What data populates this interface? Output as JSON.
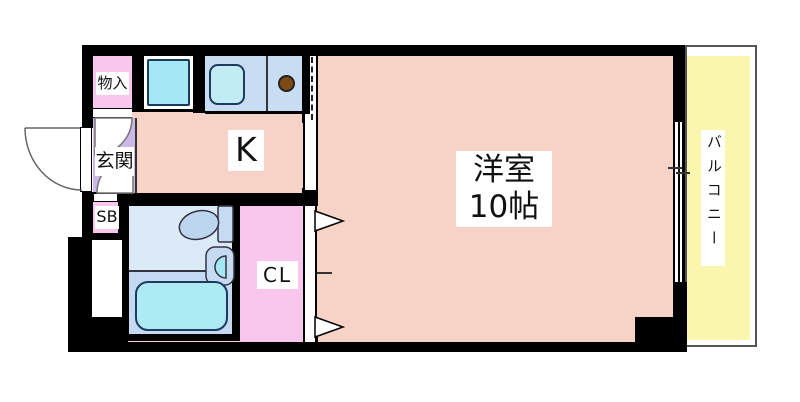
{
  "plan": {
    "labels": {
      "storage": "物入",
      "entrance": "玄関",
      "shoe_box": "SB",
      "kitchen": "K",
      "main_room_name": "洋室",
      "main_room_size": "10帖",
      "closet": "CL",
      "balcony": "バルコニー"
    },
    "colors": {
      "wall": "#000000",
      "room_floor": "#f6d3c6",
      "closet_pink": "#f9c7ee",
      "entrance_lavender": "#cbb7e8",
      "kitchen_counter_blue": "#c8dcf2",
      "bathroom_light_blue": "#dceaf8",
      "bathroom_mid_blue": "#c4d9f2",
      "fixture_cyan": "#a5e8f5",
      "balcony_yellow": "#fbf6ae",
      "stove_burner_brown": "#7d4a15"
    }
  }
}
